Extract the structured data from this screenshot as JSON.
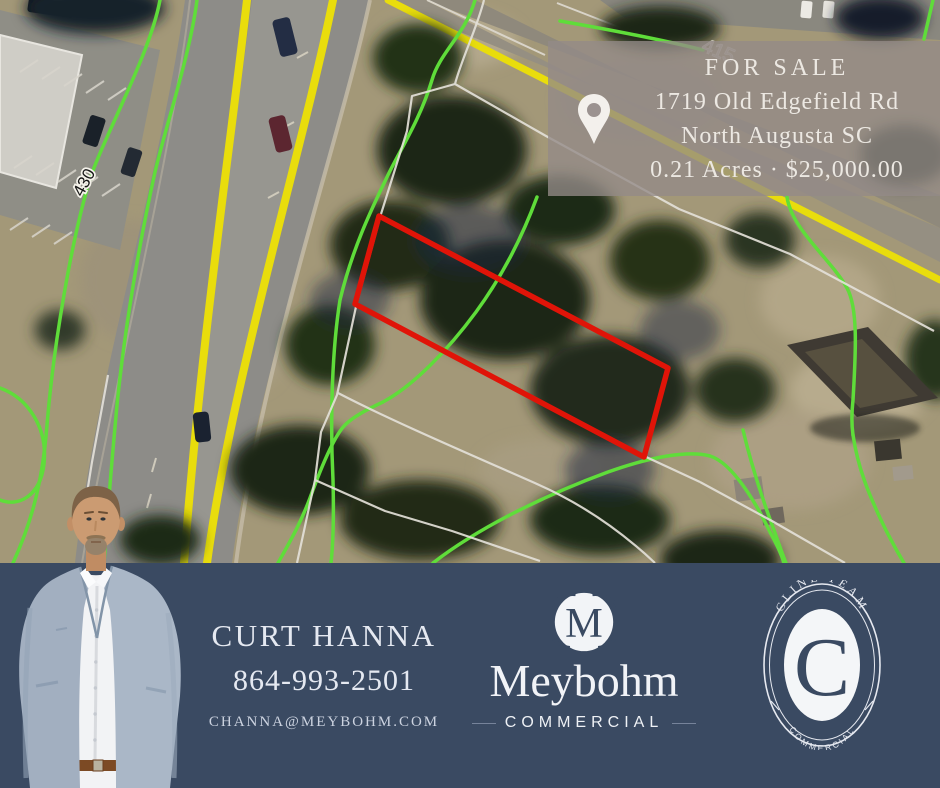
{
  "listing_card": {
    "pin_icon": "location-pin",
    "title": "FOR SALE",
    "address_line1": "1719 Old Edgefield Rd",
    "address_line2": "North Augusta SC",
    "details": "0.21 Acres · $25,000.00"
  },
  "map": {
    "contour_label": "430",
    "road_label": "415"
  },
  "agent": {
    "name": "CURT HANNA",
    "phone": "864-993-2501",
    "email": "CHANNA@MEYBOHM.COM"
  },
  "brand": {
    "logo_initial": "M",
    "name": "Meybohm",
    "division": "COMMERCIAL"
  },
  "team_badge": {
    "team_name": "CLINE TEAM",
    "initial": "C",
    "division": "COMMERCIAL"
  },
  "colors": {
    "banner": "#3a4a62",
    "parcel_outline": "#e01408",
    "contour_line": "#5fdd3a",
    "road_stripe": "#e9dd0c",
    "card_background": "rgba(148,139,136,0.78)",
    "card_text": "#ece8e2"
  }
}
